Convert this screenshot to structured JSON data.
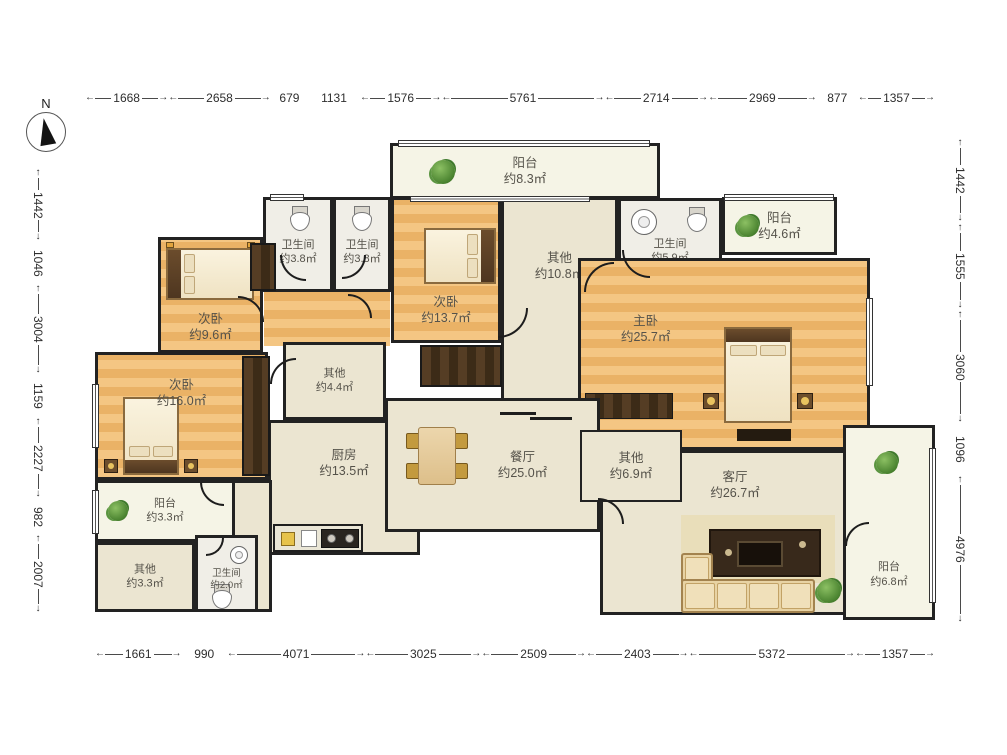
{
  "compass": {
    "label": "N"
  },
  "dims": {
    "top": [
      "1668",
      "2658",
      "679",
      "1131",
      "1576",
      "5761",
      "2714",
      "2969",
      "877",
      "1357"
    ],
    "bottom": [
      "1661",
      "990",
      "4071",
      "3025",
      "2509",
      "2403",
      "5372",
      "1357"
    ],
    "left": [
      "1442",
      "1046",
      "3004",
      "1159",
      "2227",
      "982",
      "2007"
    ],
    "right": [
      "1442",
      "1555",
      "3060",
      "1096",
      "4976"
    ]
  },
  "rooms": {
    "balcony_top": {
      "name": "阳台",
      "area": "约8.3㎡"
    },
    "bath_a": {
      "name": "卫生间",
      "area": "约3.8㎡"
    },
    "bath_b": {
      "name": "卫生间",
      "area": "约3.8㎡"
    },
    "bedroom_tm": {
      "name": "次卧",
      "area": "约13.7㎡"
    },
    "hall": {
      "name": "其他",
      "area": "约10.8㎡"
    },
    "bath_c": {
      "name": "卫生间",
      "area": "约5.9㎡"
    },
    "balcony_tr": {
      "name": "阳台",
      "area": "约4.6㎡"
    },
    "bedroom_tl": {
      "name": "次卧",
      "area": "约9.6㎡"
    },
    "master": {
      "name": "主卧",
      "area": "约25.7㎡"
    },
    "bedroom_l": {
      "name": "次卧",
      "area": "约16.0㎡"
    },
    "other44": {
      "name": "其他",
      "area": "约4.4㎡"
    },
    "kitchen": {
      "name": "厨房",
      "area": "约13.5㎡"
    },
    "dining": {
      "name": "餐厅",
      "area": "约25.0㎡"
    },
    "other69": {
      "name": "其他",
      "area": "约6.9㎡"
    },
    "living": {
      "name": "客厅",
      "area": "约26.7㎡"
    },
    "balcony_l": {
      "name": "阳台",
      "area": "约3.3㎡"
    },
    "other33": {
      "name": "其他",
      "area": "约3.3㎡"
    },
    "bath_d": {
      "name": "卫生间",
      "area": "约2.0㎡"
    },
    "balcony_r": {
      "name": "阳台",
      "area": "约6.8㎡"
    }
  },
  "palette": {
    "wood": "#eeb870",
    "cream": "#ebe5d1",
    "bath": "#f0eee7",
    "balcony": "#f5f4e6",
    "wall": "#1f1f1f",
    "plant_green": "#4e8f3a",
    "dim_text": "#2e2e2e"
  }
}
